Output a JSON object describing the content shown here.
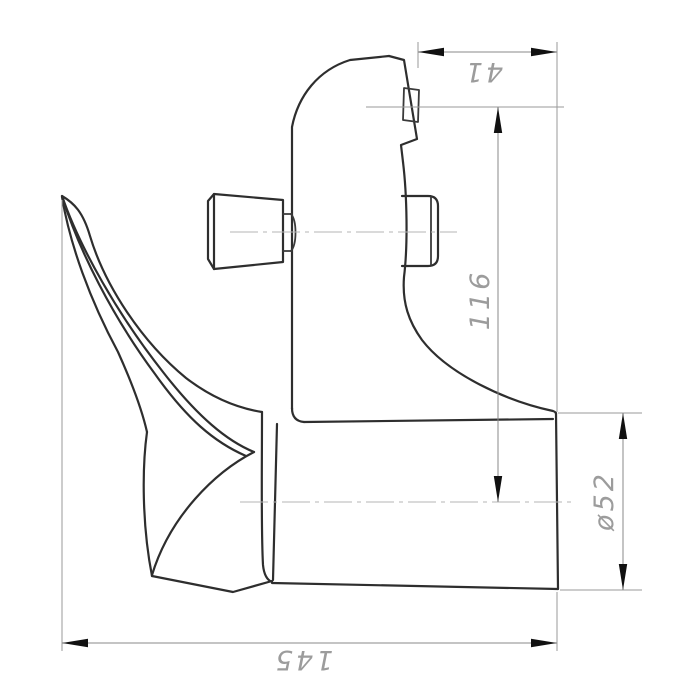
{
  "page": {
    "background": "#ffffff",
    "width": 700,
    "height": 700
  },
  "drawing": {
    "subject": "single-lever mixer faucet, side elevation technical drawing",
    "colors": {
      "outline": "#2e2e2e",
      "dimension_lines": "#8a8a8a",
      "centerlines": "#b4b4b4",
      "dimension_text": "#9c9c9c",
      "arrowheads": "#111111"
    },
    "dimensions": [
      {
        "id": "top-width",
        "label": "41",
        "value": 41,
        "orientation": "horizontal",
        "position": "top-right",
        "text_rotation_deg": 180
      },
      {
        "id": "body-height",
        "label": "116",
        "value": 116,
        "orientation": "vertical",
        "position": "right",
        "text_rotation_deg": -90
      },
      {
        "id": "outlet-diameter",
        "label": "ø52",
        "value": 52,
        "orientation": "vertical",
        "position": "far-right",
        "text_rotation_deg": -90
      },
      {
        "id": "overall-depth",
        "label": "145",
        "value": 145,
        "orientation": "horizontal",
        "position": "bottom",
        "text_rotation_deg": 180
      }
    ]
  }
}
